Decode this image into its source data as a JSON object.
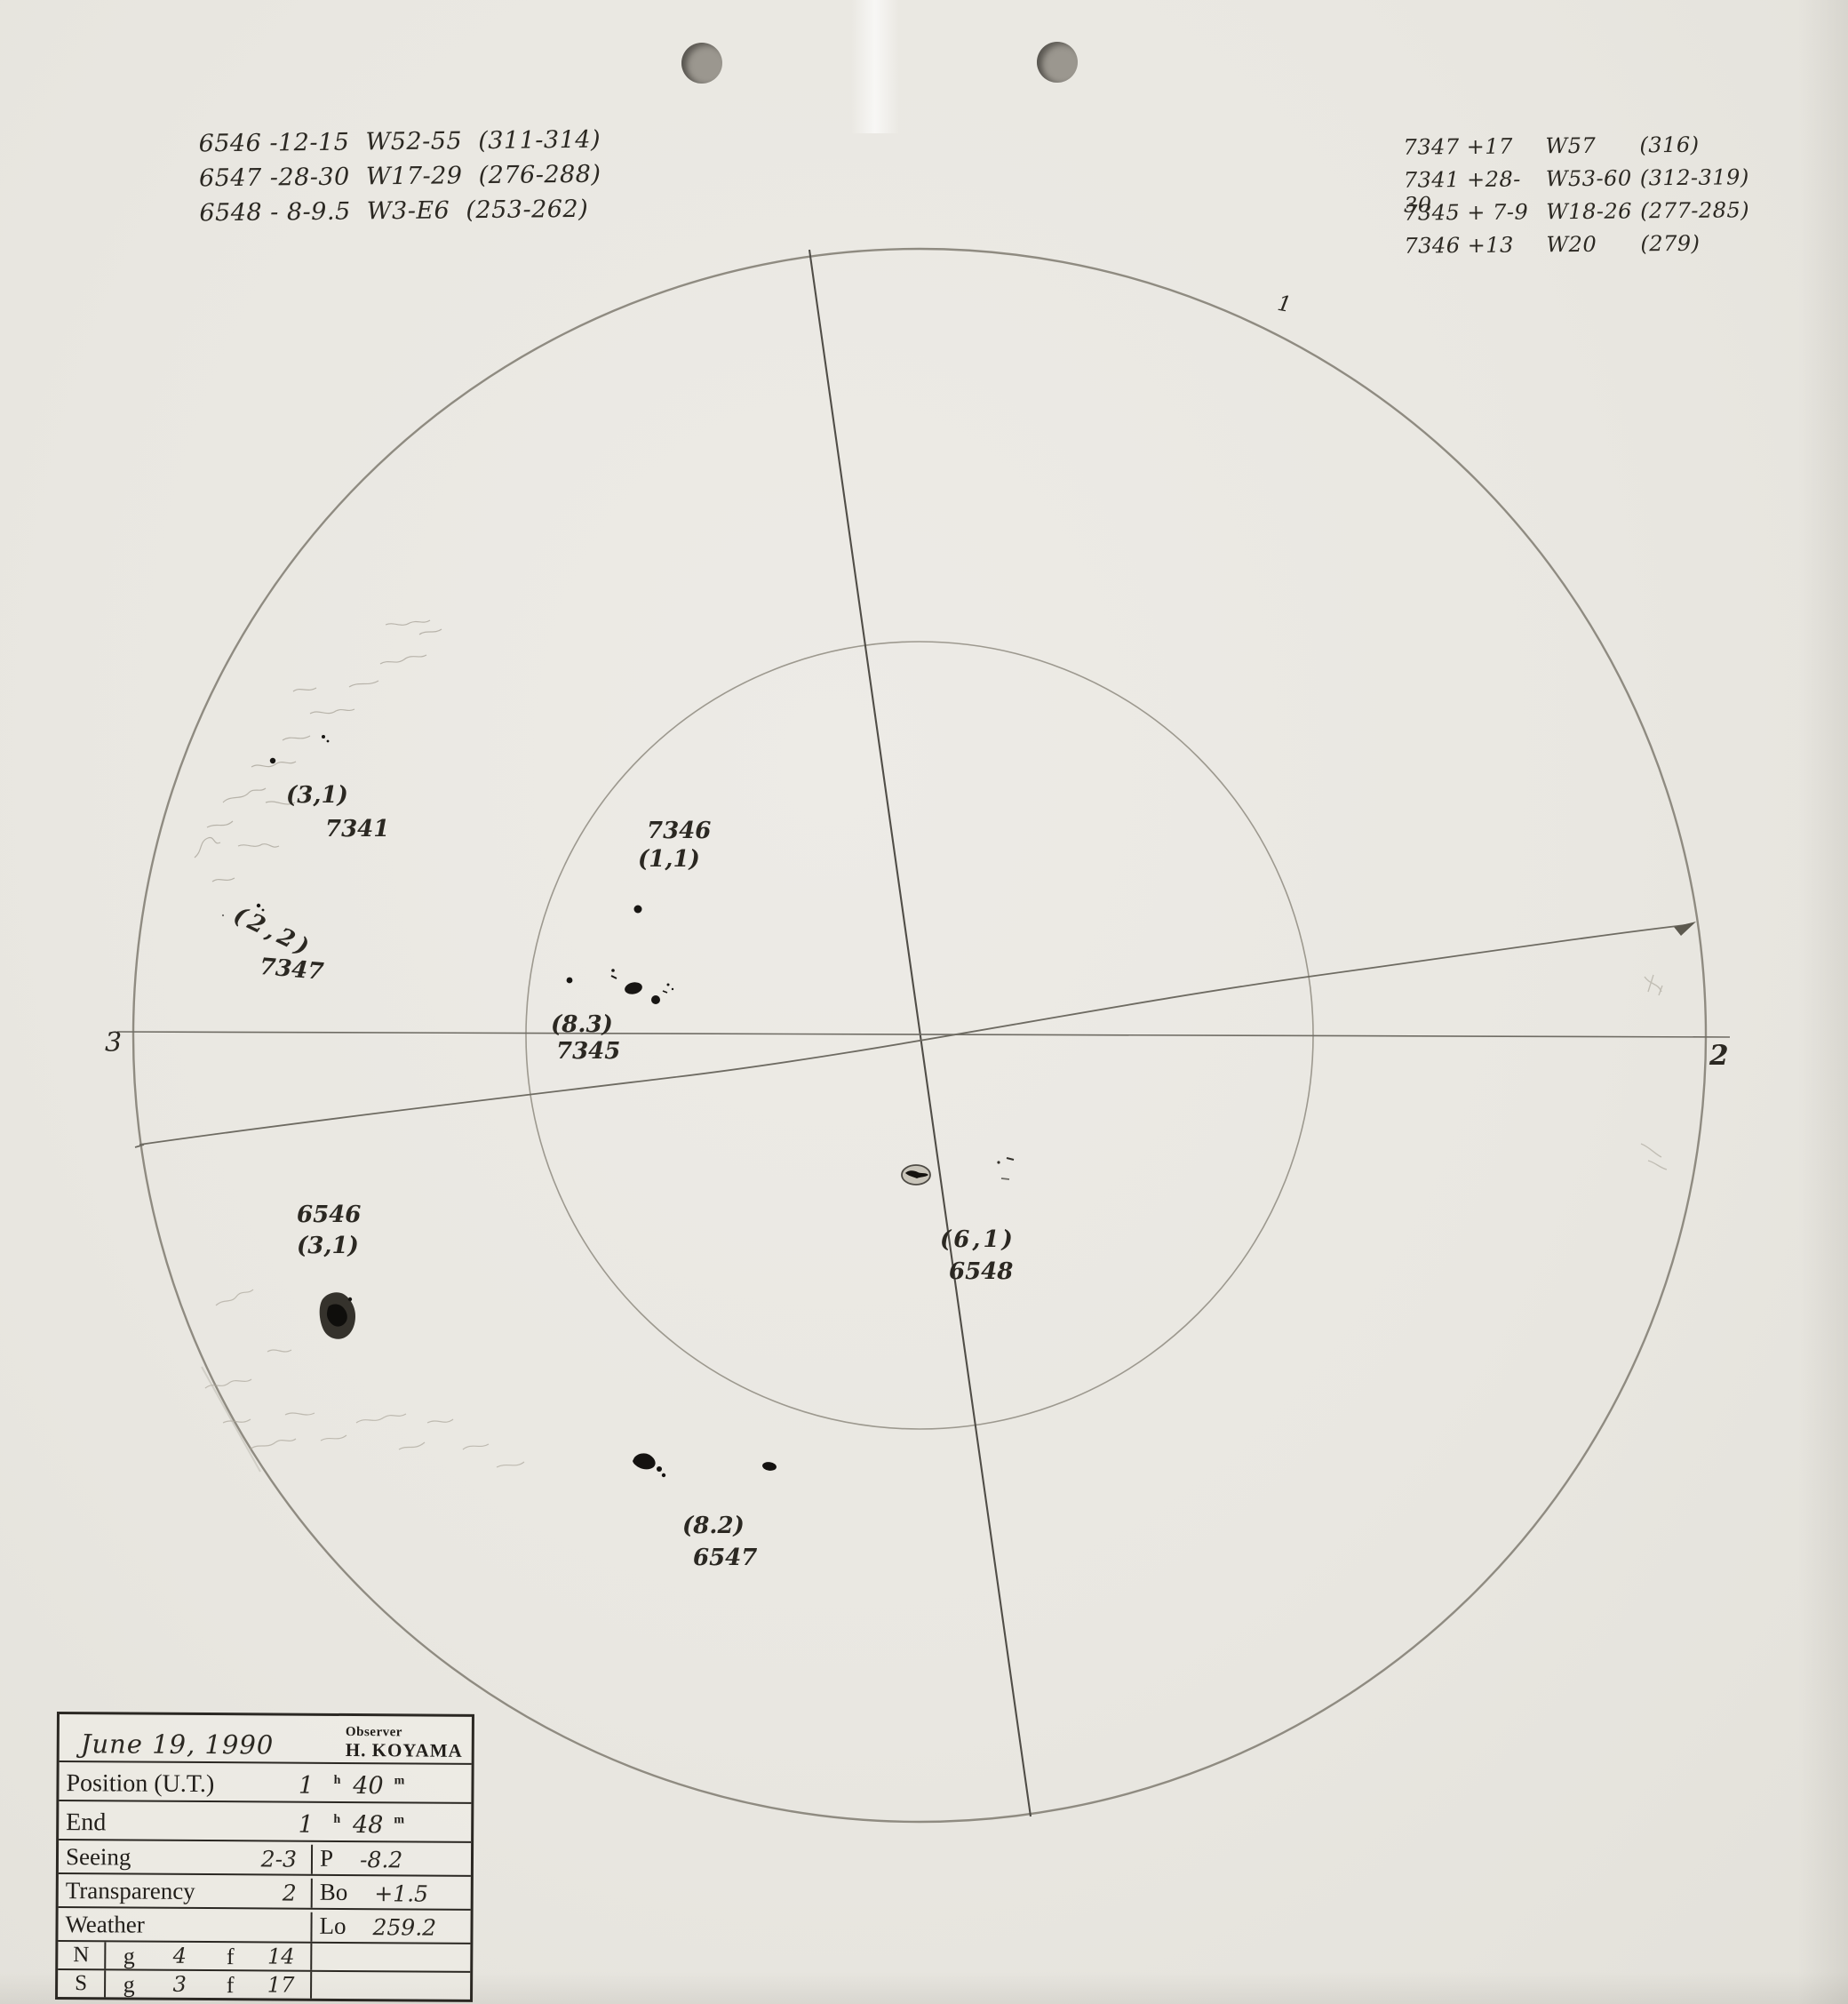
{
  "annotations": {
    "top_left": [
      "6546 -12-15  W52-55  (311-314)",
      "6547 -28-30  W17-29  (276-288)",
      "6548 - 8-9.5  W3-E6  (253-262)"
    ],
    "top_right": [
      {
        "g": "7347 +17",
        "w": "W57",
        "c": "(316)"
      },
      {
        "g": "7341 +28-30",
        "w": "W53-60",
        "c": "(312-319)"
      },
      {
        "g": "7345 + 7-9",
        "w": "W18-26",
        "c": "(277-285)"
      },
      {
        "g": "7346 +13",
        "w": "W20",
        "c": "(279)"
      }
    ]
  },
  "disk": {
    "orientation": {
      "top": "1",
      "right": "2",
      "left": "3"
    },
    "groups": {
      "g7341": {
        "count": "(3,1)",
        "id": "7341"
      },
      "g7347": {
        "count": "(2,2)",
        "id": "7347"
      },
      "g7346": {
        "id": "7346",
        "count": "(1,1)"
      },
      "g7345": {
        "count": "(8.3)",
        "id": "7345"
      },
      "g6548": {
        "count": "(6,1)",
        "id": "6548"
      },
      "g6546": {
        "id": "6546",
        "count": "(3,1)"
      },
      "g6547": {
        "count": "(8.2)",
        "id": "6547"
      }
    }
  },
  "table": {
    "date": "June 19, 1990",
    "observer_label": "Observer",
    "observer_name": "H. KOYAMA",
    "position_label": "Position (U.T.)",
    "position_h": "1",
    "position_m": "40",
    "end_label": "End",
    "end_h": "1",
    "end_m": "48",
    "h_unit": "h",
    "m_unit": "m",
    "seeing_label": "Seeing",
    "seeing_value": "2-3",
    "p_label": "P",
    "p_value": "-8.2",
    "transparency_label": "Transparency",
    "transparency_value": "2",
    "bo_label": "Bo",
    "bo_value": "+1.5",
    "weather_label": "Weather",
    "lo_label": "Lo",
    "lo_value": "259.2",
    "n_label": "N",
    "s_label": "S",
    "g_label": "g",
    "f_label": "f",
    "n_g": "4",
    "n_f": "14",
    "s_g": "3",
    "s_f": "17"
  },
  "colors": {
    "paper": "#e9e7e1",
    "ink": "#2b2822",
    "pencil": "#8f8b81"
  }
}
